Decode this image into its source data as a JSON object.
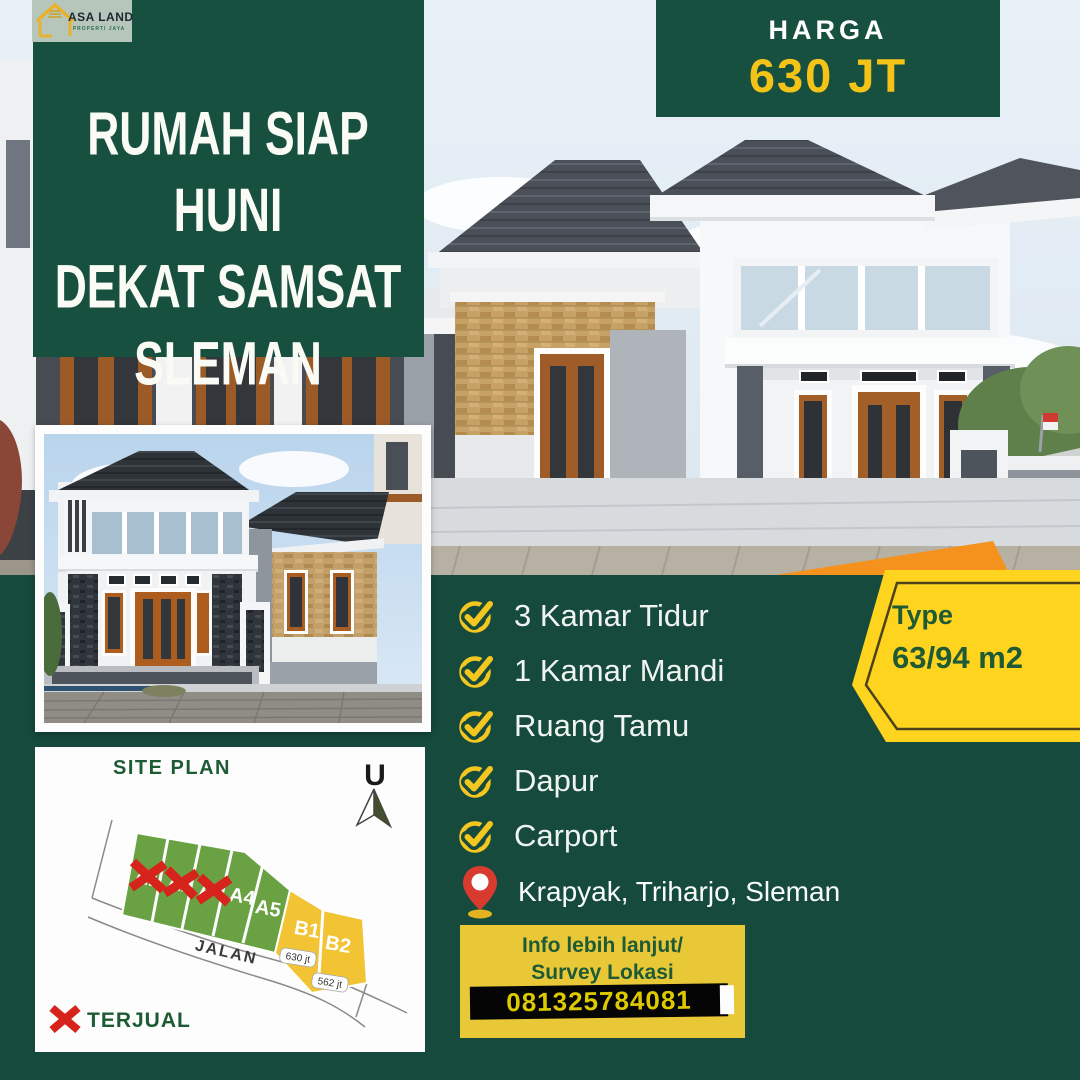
{
  "brand": {
    "name": "ASA LAND",
    "tagline": "PROPERTI JAYA"
  },
  "title": {
    "lines": [
      "RUMAH SIAP HUNI",
      "DEKAT SAMSAT",
      "SLEMAN"
    ]
  },
  "price": {
    "label": "HARGA",
    "value": "630 JT"
  },
  "type_badge": {
    "label": "Type",
    "value": "63/94 m2"
  },
  "features": [
    "3 Kamar Tidur",
    "1 Kamar Mandi",
    "Ruang Tamu",
    "Dapur",
    "Carport"
  ],
  "location": {
    "text": "Krapyak, Triharjo, Sleman"
  },
  "contact": {
    "line1": "Info lebih lanjut/",
    "line2": "Survey Lokasi",
    "phone": "081325784081"
  },
  "site_plan": {
    "title": "SITE PLAN",
    "compass_label": "U",
    "road_label": "JALAN",
    "legend_label": "TERJUAL",
    "plots": [
      {
        "id": "A1",
        "status": "sold",
        "color": "#6aa243"
      },
      {
        "id": "A2",
        "status": "sold",
        "color": "#6aa243"
      },
      {
        "id": "A3",
        "status": "sold",
        "color": "#6aa243"
      },
      {
        "id": "A4",
        "status": "available",
        "color": "#6aa243"
      },
      {
        "id": "A5",
        "status": "available",
        "color": "#6aa243"
      },
      {
        "id": "B1",
        "status": "available",
        "color": "#f2c434",
        "price": "630 jt"
      },
      {
        "id": "B2",
        "status": "available",
        "color": "#f2c434",
        "price": "562 jt"
      }
    ]
  },
  "colors": {
    "brand_green": "#17503f",
    "background_green": "#154a3c",
    "accent_yellow": "#ffd41f",
    "price_yellow": "#f4c318",
    "contact_yellow": "#e9c838",
    "accent_orange": "#f5921e",
    "sold_red": "#d6231c",
    "plot_green": "#6aa243",
    "plot_yellow": "#f2c434",
    "logo_bg": "#b7c6bb"
  }
}
